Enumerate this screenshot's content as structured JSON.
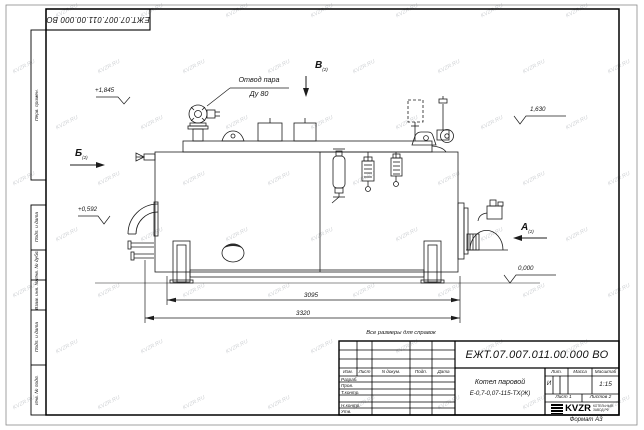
{
  "page": {
    "format_label": "Формат А3"
  },
  "watermark": {
    "text": "KVZR.RU"
  },
  "top_stamp": {
    "doc_number": "ЕЖТ.07.007.011.00.000  ВО"
  },
  "margin_columns": {
    "first_use": "Перв. примен.",
    "cells": [
      "Подп. и дата",
      "Инв. № дубл.",
      "Взам. инв. №",
      "Подп. и дата",
      "Инв. № подл."
    ]
  },
  "drawing": {
    "note": "Все размеры для справок",
    "steam_outlet": {
      "line1": "Отвод пара",
      "line2": "Ду 80"
    },
    "elevations": {
      "valve_top": "+1,845",
      "rear": "1,630",
      "burner": "+0,592",
      "ground": "0,000"
    },
    "dimensions": {
      "inner_length": "3095",
      "overall_length": "3320"
    },
    "views": {
      "a": {
        "letter": "А",
        "ref": "(2)"
      },
      "b": {
        "letter": "Б",
        "ref": "(2)"
      },
      "v": {
        "letter": "В",
        "ref": "(2)"
      }
    }
  },
  "title_block": {
    "doc_number": "ЕЖТ.07.007.011.00.000  ВО",
    "product_name_line1": "Котел паровой",
    "product_name_line2": "Е-0,7-0,07-115-ТХ(Ж)",
    "header_cols": [
      "Изм.",
      "Лист",
      "N докум.",
      "Подп.",
      "Дата"
    ],
    "role_rows": [
      "Разраб.",
      "Пров.",
      "Т.контр.",
      "",
      "Н.контр.",
      "Утв."
    ],
    "lit_label": "Лит.",
    "lit_value": "И",
    "mass_label": "Масса",
    "scale_label": "Масштаб",
    "scale_value": "1:15",
    "sheet_label": "Лист",
    "sheet_value": "1",
    "sheets_label": "Листов",
    "sheets_value": "2",
    "logo_text": "KVZR",
    "logo_caption_line1": "КОТЕЛЬНЫЙ",
    "logo_caption_line2": "ЗАВОД.РФ"
  }
}
